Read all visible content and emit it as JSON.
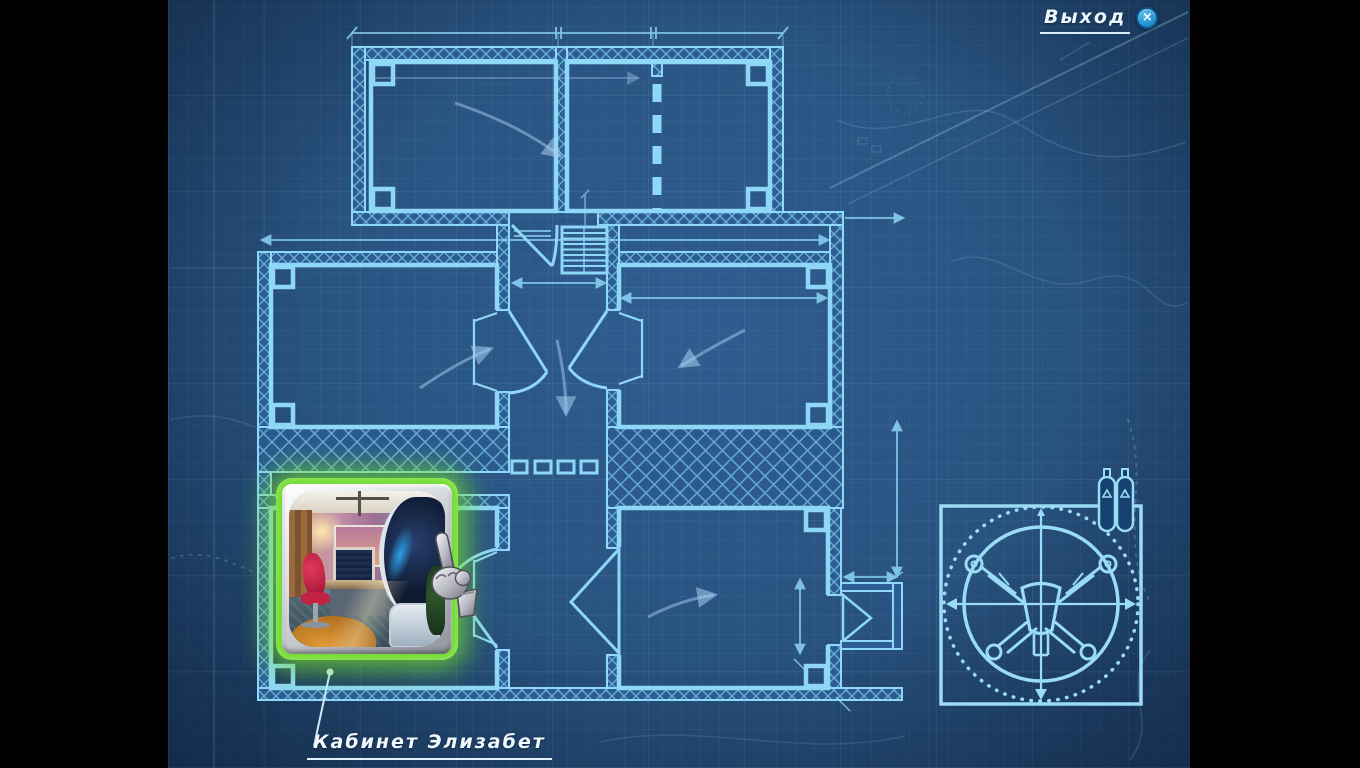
{
  "screen": {
    "name": "blueprint-map",
    "letterbox_color": "#000000"
  },
  "exit_button": {
    "label": "Выход",
    "close_glyph": "×"
  },
  "map_label": {
    "text": "Кабинет Элизабет"
  },
  "thumbnail": {
    "location": "Кабинет Элизабет",
    "state": "highlighted"
  },
  "icons": {
    "close": "close-icon",
    "hand_cursor": "hand-cursor-icon",
    "gas_tanks": "gas-tanks-icon",
    "emblem": "vehicle-schematic-icon"
  },
  "colors": {
    "blueprint_background": "#28527f",
    "plan_line": "#8ed7f6",
    "highlight_glow": "#6fdc2b",
    "close_button": "#2597d4",
    "label_text": "#f1f8fe"
  }
}
